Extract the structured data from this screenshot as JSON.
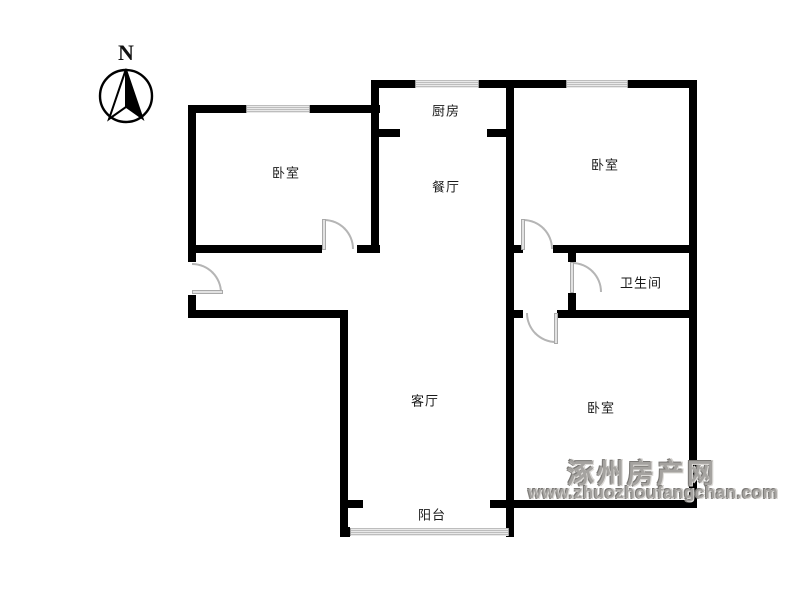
{
  "compass": {
    "north_label": "N"
  },
  "rooms": {
    "kitchen": "厨房",
    "dining": "餐厅",
    "bedroom_top_left": "卧室",
    "bedroom_top_right": "卧室",
    "bathroom": "卫生间",
    "living_room": "客厅",
    "bedroom_bottom_right": "卧室",
    "balcony": "阳台"
  },
  "watermark": {
    "site_name": "涿州房产网",
    "site_url": "www.zhuozhoufangchan.com"
  },
  "colors": {
    "background": "#ffffff",
    "wall": "#000000",
    "door": "#b5b5b5",
    "window_stripe": "#bdbdbd",
    "label_text": "#1a1a1a",
    "watermark": "#a5a3a0"
  }
}
